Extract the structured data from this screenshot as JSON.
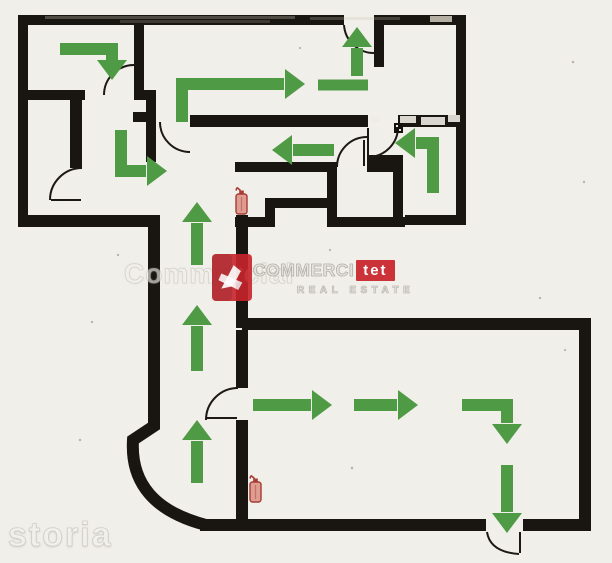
{
  "colors": {
    "background": "#f1efe9",
    "wall": "#191511",
    "arrow": "#4f9a44",
    "door_line": "#1c1914",
    "extinguisher_outline": "#a63c32",
    "extinguisher_fill": "#df9d92",
    "brand_red": "#c8242b",
    "watermark_text": "rgba(252,252,250,0.6)"
  },
  "watermark": {
    "ghost": "Commercial",
    "brand": "COMMERCI",
    "brand_highlight": "tet",
    "tagline": "REAL ESTATE",
    "portal": "storia"
  },
  "plan": {
    "arrows": [
      {
        "id": "room-topleft-right-down",
        "points": [
          [
            60,
            49
          ],
          [
            112,
            49
          ],
          [
            112,
            60
          ]
        ],
        "head": {
          "tip": [
            112,
            80
          ],
          "dir": "down"
        }
      },
      {
        "id": "room-topmid-up-right",
        "points": [
          [
            182,
            122
          ],
          [
            182,
            84
          ],
          [
            284,
            84
          ]
        ],
        "head": {
          "tip": [
            305,
            84
          ],
          "dir": "right"
        }
      },
      {
        "id": "top-exit-up",
        "points": [
          [
            357,
            76
          ],
          [
            357,
            48
          ]
        ],
        "head": {
          "tip": [
            357,
            27
          ],
          "dir": "up"
        }
      },
      {
        "id": "top-exit-base-bar",
        "points": [
          [
            318,
            85
          ],
          [
            368,
            85
          ]
        ],
        "head": null,
        "width": 11
      },
      {
        "id": "corridor-left",
        "points": [
          [
            334,
            150
          ],
          [
            293,
            150
          ]
        ],
        "head": {
          "tip": [
            272,
            150
          ],
          "dir": "left"
        }
      },
      {
        "id": "room-right-left-out",
        "points": [
          [
            433,
            193
          ],
          [
            433,
            143
          ],
          [
            416,
            143
          ]
        ],
        "head": {
          "tip": [
            395,
            143
          ],
          "dir": "left"
        }
      },
      {
        "id": "junction-down-right",
        "points": [
          [
            121,
            130
          ],
          [
            121,
            171
          ],
          [
            146,
            171
          ]
        ],
        "head": {
          "tip": [
            167,
            171
          ],
          "dir": "right"
        }
      },
      {
        "id": "vertical-corridor-up-1",
        "points": [
          [
            197,
            265
          ],
          [
            197,
            223
          ]
        ],
        "head": {
          "tip": [
            197,
            202
          ],
          "dir": "up"
        }
      },
      {
        "id": "vertical-corridor-up-2",
        "points": [
          [
            197,
            371
          ],
          [
            197,
            326
          ]
        ],
        "head": {
          "tip": [
            197,
            305
          ],
          "dir": "up"
        }
      },
      {
        "id": "vertical-corridor-up-3",
        "points": [
          [
            197,
            483
          ],
          [
            197,
            441
          ]
        ],
        "head": {
          "tip": [
            197,
            420
          ],
          "dir": "up"
        }
      },
      {
        "id": "bigroom-right-1",
        "points": [
          [
            253,
            405
          ],
          [
            311,
            405
          ]
        ],
        "head": {
          "tip": [
            332,
            405
          ],
          "dir": "right"
        }
      },
      {
        "id": "bigroom-right-2",
        "points": [
          [
            354,
            405
          ],
          [
            397,
            405
          ]
        ],
        "head": {
          "tip": [
            418,
            405
          ],
          "dir": "right"
        }
      },
      {
        "id": "bigroom-right-down",
        "points": [
          [
            462,
            405
          ],
          [
            507,
            405
          ],
          [
            507,
            423
          ]
        ],
        "head": {
          "tip": [
            507,
            444
          ],
          "dir": "down"
        }
      },
      {
        "id": "bigroom-exit-down",
        "points": [
          [
            507,
            465
          ],
          [
            507,
            512
          ]
        ],
        "head": {
          "tip": [
            507,
            533
          ],
          "dir": "down"
        }
      }
    ],
    "extinguisher_positions": [
      {
        "x": 236,
        "y": 186
      },
      {
        "x": 250,
        "y": 474
      }
    ]
  }
}
